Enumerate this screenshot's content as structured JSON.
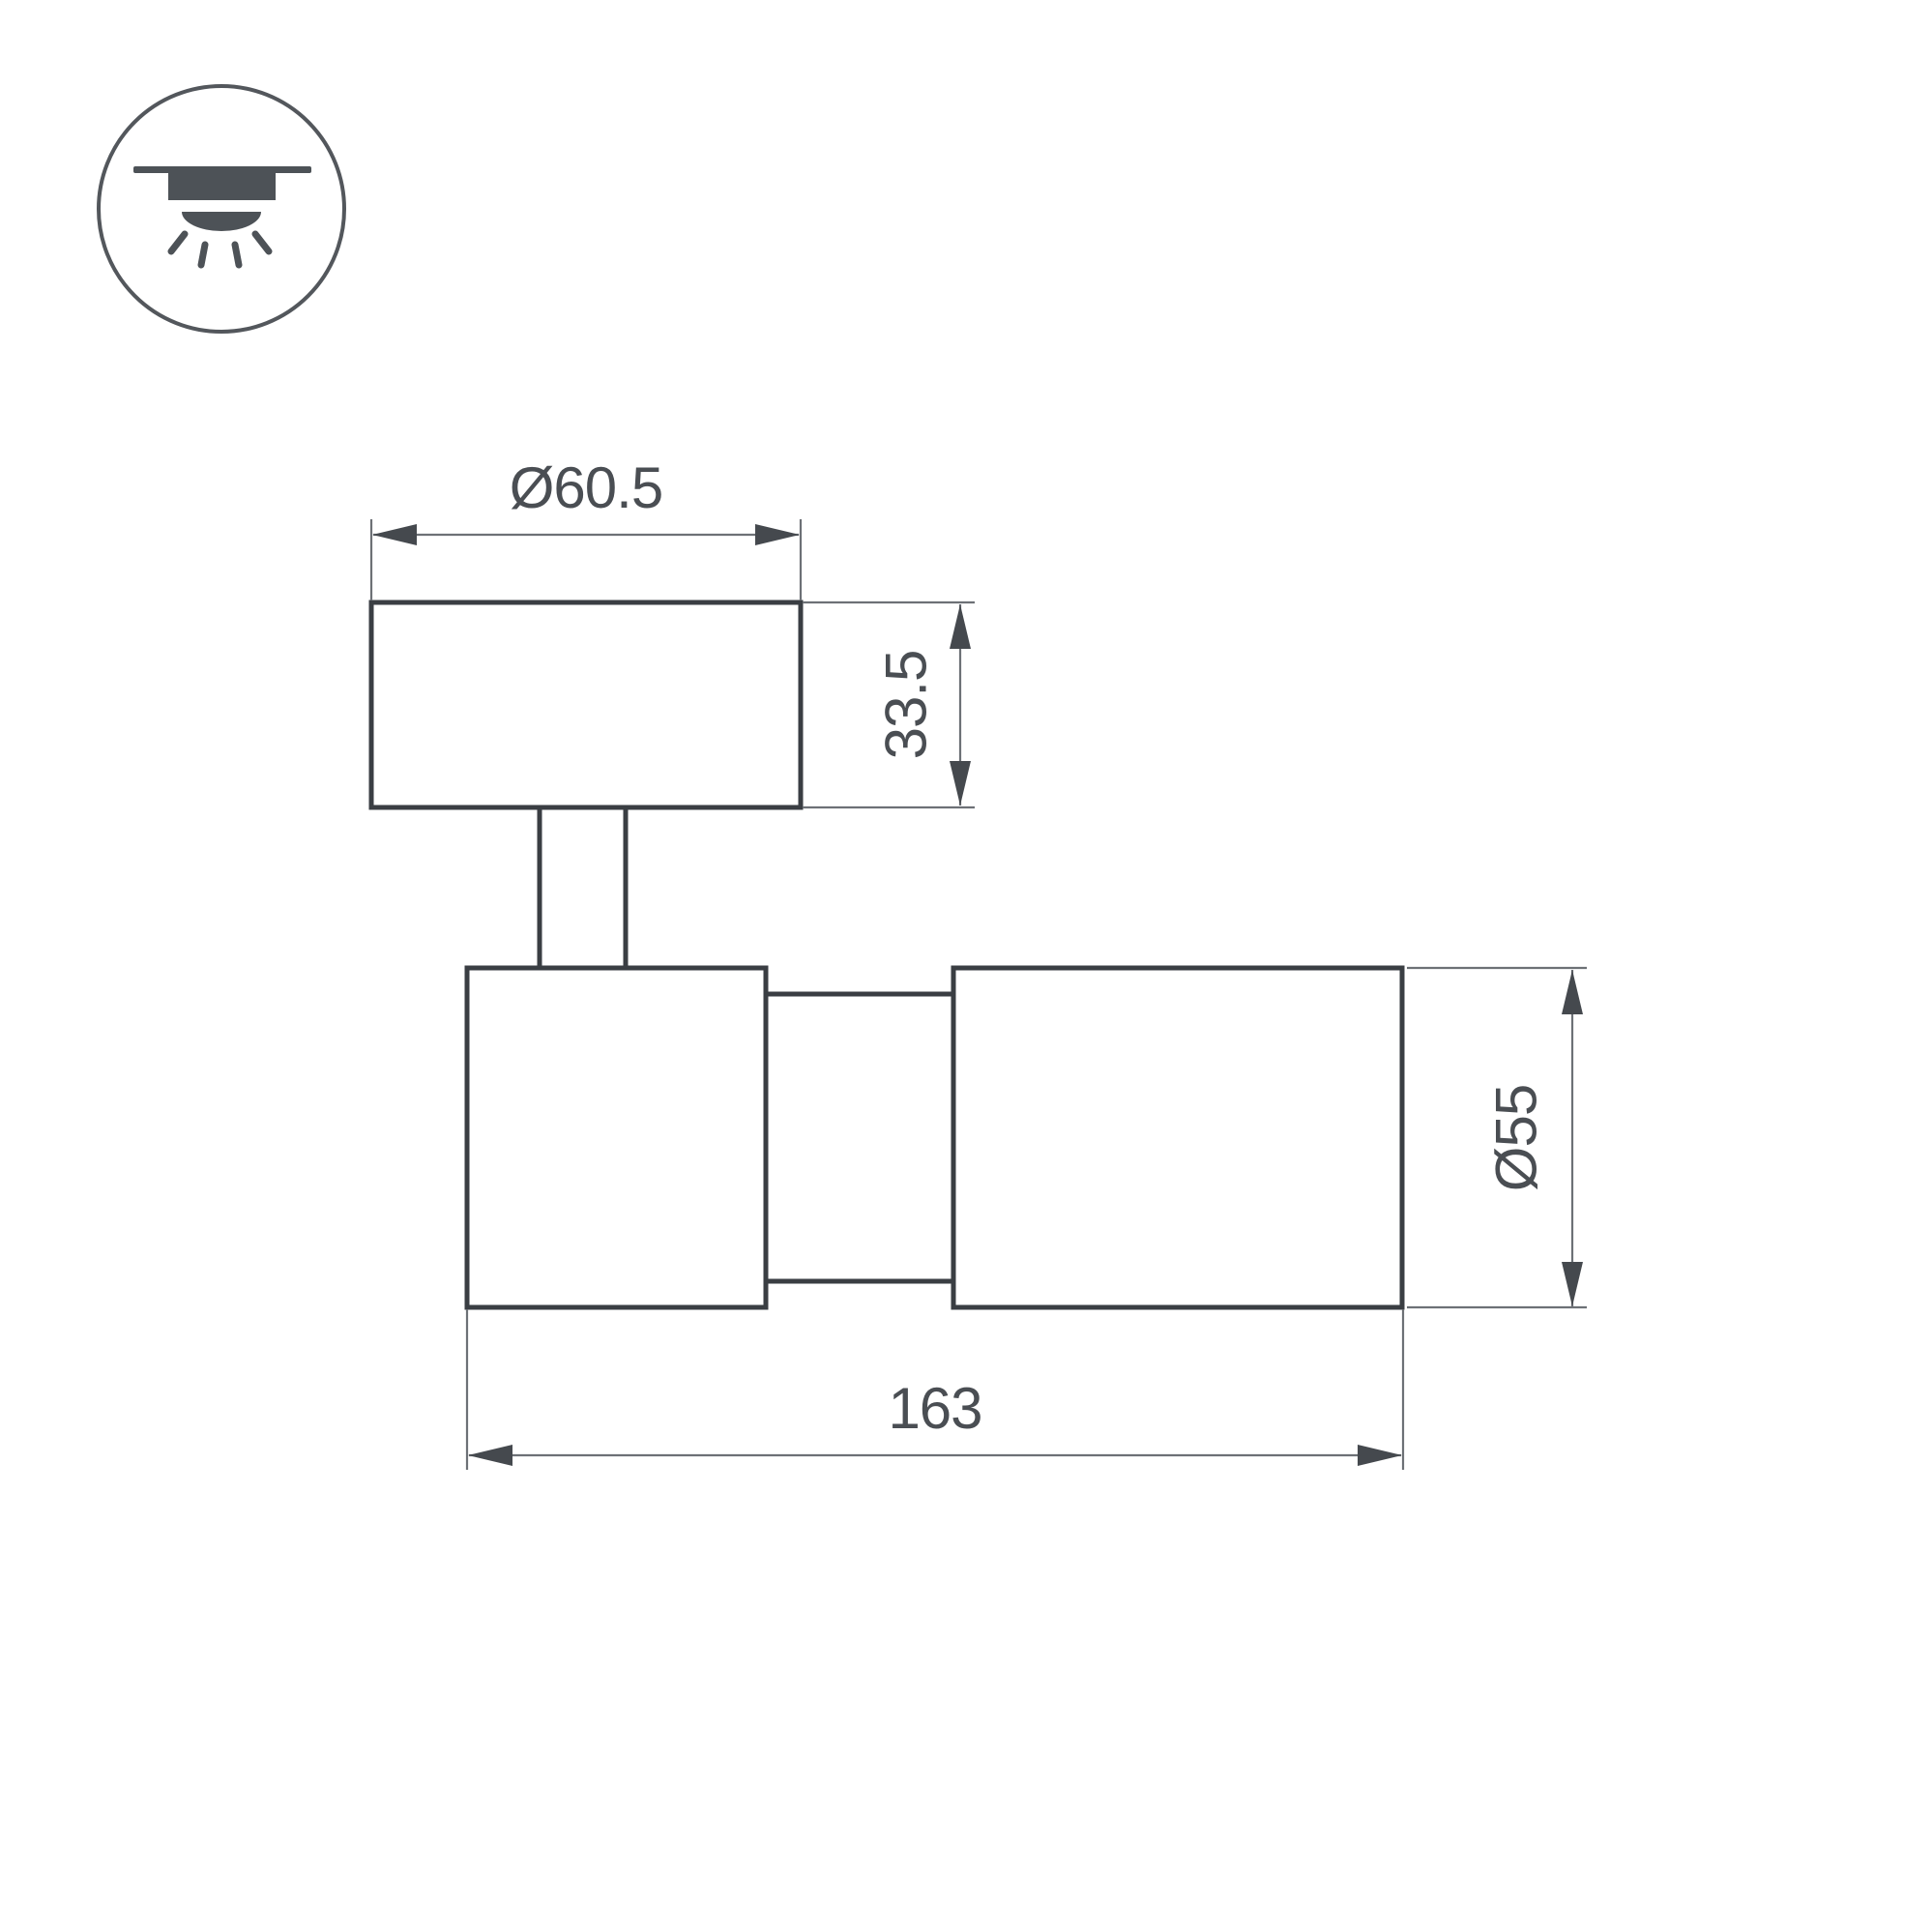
{
  "title": "Spot luminaire technical dimension drawing",
  "icon": {
    "label": "surface-mounted-ceiling-light"
  },
  "dimensions": {
    "base_diameter": "Ø60.5",
    "base_height": "33.5",
    "body_length": "163",
    "body_diameter": "Ø55"
  },
  "colors": {
    "background": "#ffffff",
    "object_line": "#3a3e43",
    "dimension_line": "#6d7176",
    "arrow": "#45494e",
    "text": "#4a4e53",
    "icon": "#4d5257"
  }
}
